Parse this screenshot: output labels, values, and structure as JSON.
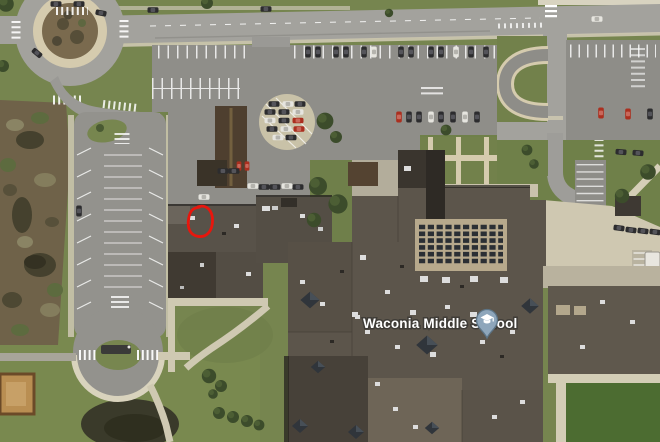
{
  "poi": {
    "label": "Waconia Middle School",
    "type": "school",
    "pin_icon": "graduation-cap",
    "pin_fill": "#8ea6bb",
    "pin_border": "#5c7486",
    "label_color": "#ffffff",
    "label_halo": "#3f3c37"
  },
  "annotation": {
    "shape": "hand-drawn-circle",
    "color": "#e8160d"
  },
  "imagery": {
    "kind": "satellite",
    "colors": {
      "grass": "#76854f",
      "sports_field": "#4c6c31",
      "asphalt_road": "#a3a29d",
      "asphalt_lot": "#8f8e89",
      "sidewalk": "#d7d0b8",
      "roof_dark": "#3f3a32",
      "roof_mid": "#5c554b",
      "wetland": "#6f6249",
      "pond": "#3a3a2a"
    }
  }
}
